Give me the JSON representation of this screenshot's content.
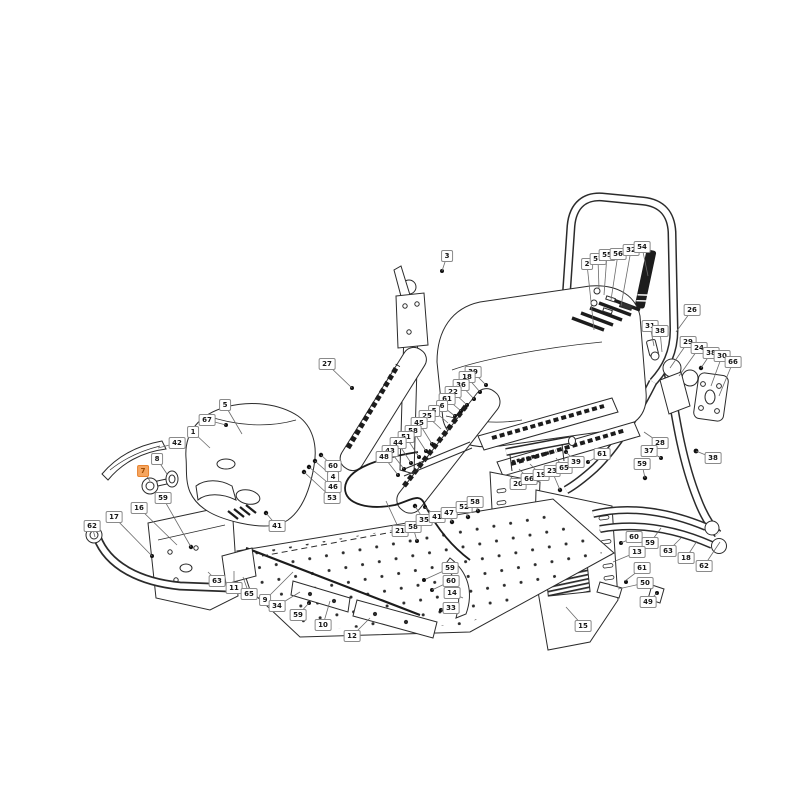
{
  "diagram": {
    "title": "mower-exploded-parts-diagram",
    "background": "#ffffff",
    "line_color": "#2b2b2b",
    "leader_color": "#6a6a6a",
    "label_style": {
      "bg": "#ffffff",
      "border": "#8a8a8a",
      "text": "#161616"
    },
    "highlight_style": {
      "bg": "#f5a55f",
      "border": "#e8832f",
      "text": "#9c4a00"
    },
    "highlighted_part": "7",
    "callouts": [
      {
        "n": "5",
        "x": 225,
        "y": 405,
        "tx": 242,
        "ty": 434
      },
      {
        "n": "67",
        "x": 207,
        "y": 420,
        "tx": 226,
        "ty": 425
      },
      {
        "n": "1",
        "x": 193,
        "y": 432,
        "tx": 210,
        "ty": 448
      },
      {
        "n": "42",
        "x": 177,
        "y": 443,
        "tx": 158,
        "ty": 448
      },
      {
        "n": "8",
        "x": 157,
        "y": 459,
        "tx": 167,
        "ty": 474
      },
      {
        "n": "7",
        "x": 143,
        "y": 471,
        "tx": 150,
        "ty": 481,
        "highlight": true
      },
      {
        "n": "59",
        "x": 163,
        "y": 498,
        "tx": 191,
        "ty": 547
      },
      {
        "n": "16",
        "x": 139,
        "y": 508,
        "tx": 177,
        "ty": 545
      },
      {
        "n": "17",
        "x": 114,
        "y": 517,
        "tx": 152,
        "ty": 556
      },
      {
        "n": "62",
        "x": 92,
        "y": 526,
        "tx": 95,
        "ty": 537
      },
      {
        "n": "41",
        "x": 277,
        "y": 526,
        "tx": 266,
        "ty": 513
      },
      {
        "n": "63",
        "x": 217,
        "y": 581,
        "tx": 208,
        "ty": 572
      },
      {
        "n": "11",
        "x": 234,
        "y": 588,
        "tx": 234,
        "ty": 571
      },
      {
        "n": "65",
        "x": 249,
        "y": 594,
        "tx": 243,
        "ty": 577
      },
      {
        "n": "9",
        "x": 265,
        "y": 600,
        "tx": 293,
        "ty": 572
      },
      {
        "n": "34",
        "x": 277,
        "y": 606,
        "tx": 300,
        "ty": 592
      },
      {
        "n": "59",
        "x": 298,
        "y": 615,
        "tx": 309,
        "ty": 603
      },
      {
        "n": "10",
        "x": 323,
        "y": 625,
        "tx": 330,
        "ty": 601
      },
      {
        "n": "12",
        "x": 352,
        "y": 636,
        "tx": 370,
        "ty": 618
      },
      {
        "n": "60",
        "x": 333,
        "y": 466,
        "tx": 321,
        "ty": 455
      },
      {
        "n": "4",
        "x": 333,
        "y": 477,
        "tx": 315,
        "ty": 461
      },
      {
        "n": "46",
        "x": 333,
        "y": 487,
        "tx": 309,
        "ty": 467
      },
      {
        "n": "53",
        "x": 332,
        "y": 498,
        "tx": 304,
        "ty": 472
      },
      {
        "n": "27",
        "x": 327,
        "y": 364,
        "tx": 352,
        "ty": 388
      },
      {
        "n": "3",
        "x": 447,
        "y": 256,
        "tx": 442,
        "ty": 271
      },
      {
        "n": "39",
        "x": 473,
        "y": 372,
        "tx": 486,
        "ty": 385
      },
      {
        "n": "18",
        "x": 467,
        "y": 377,
        "tx": 480,
        "ty": 392
      },
      {
        "n": "36",
        "x": 461,
        "y": 385,
        "tx": 474,
        "ty": 399
      },
      {
        "n": "22",
        "x": 453,
        "y": 392,
        "tx": 467,
        "ty": 405
      },
      {
        "n": "61",
        "x": 447,
        "y": 399,
        "tx": 461,
        "ty": 411
      },
      {
        "n": "6",
        "x": 442,
        "y": 406,
        "tx": 455,
        "ty": 416
      },
      {
        "n": "5",
        "x": 434,
        "y": 411,
        "tx": 448,
        "ty": 423
      },
      {
        "n": "25",
        "x": 427,
        "y": 416,
        "tx": 441,
        "ty": 429
      },
      {
        "n": "45",
        "x": 419,
        "y": 423,
        "tx": 432,
        "ty": 444
      },
      {
        "n": "58",
        "x": 413,
        "y": 431,
        "tx": 426,
        "ty": 451
      },
      {
        "n": "51",
        "x": 406,
        "y": 437,
        "tx": 419,
        "ty": 457
      },
      {
        "n": "44",
        "x": 398,
        "y": 443,
        "tx": 411,
        "ty": 463
      },
      {
        "n": "43",
        "x": 390,
        "y": 451,
        "tx": 404,
        "ty": 469
      },
      {
        "n": "48",
        "x": 384,
        "y": 457,
        "tx": 398,
        "ty": 475
      },
      {
        "n": "20",
        "x": 518,
        "y": 484,
        "tx": 508,
        "ty": 474
      },
      {
        "n": "66",
        "x": 529,
        "y": 479,
        "tx": 519,
        "ty": 469
      },
      {
        "n": "19",
        "x": 541,
        "y": 475,
        "tx": 530,
        "ty": 464
      },
      {
        "n": "23",
        "x": 552,
        "y": 471,
        "tx": 560,
        "ty": 490
      },
      {
        "n": "65",
        "x": 564,
        "y": 468,
        "tx": 556,
        "ty": 458
      },
      {
        "n": "39",
        "x": 576,
        "y": 462,
        "tx": 566,
        "ty": 452
      },
      {
        "n": "61",
        "x": 602,
        "y": 454,
        "tx": 588,
        "ty": 462
      },
      {
        "n": "2",
        "x": 587,
        "y": 264,
        "tx": 594,
        "ty": 330
      },
      {
        "n": "57",
        "x": 598,
        "y": 259,
        "tx": 599,
        "ty": 289
      },
      {
        "n": "55",
        "x": 607,
        "y": 255,
        "tx": 604,
        "ty": 295
      },
      {
        "n": "56",
        "x": 618,
        "y": 254,
        "tx": 611,
        "ty": 300
      },
      {
        "n": "32",
        "x": 631,
        "y": 250,
        "tx": 621,
        "ty": 306
      },
      {
        "n": "54",
        "x": 642,
        "y": 247,
        "tx": 648,
        "ty": 276
      },
      {
        "n": "26",
        "x": 692,
        "y": 310,
        "tx": 676,
        "ty": 332
      },
      {
        "n": "31",
        "x": 650,
        "y": 326,
        "tx": 654,
        "ty": 346
      },
      {
        "n": "38",
        "x": 660,
        "y": 331,
        "tx": 662,
        "ty": 352
      },
      {
        "n": "29",
        "x": 688,
        "y": 342,
        "tx": 670,
        "ty": 368
      },
      {
        "n": "24",
        "x": 699,
        "y": 348,
        "tx": 679,
        "ty": 376
      },
      {
        "n": "38",
        "x": 711,
        "y": 353,
        "tx": 701,
        "ty": 368
      },
      {
        "n": "30",
        "x": 722,
        "y": 356,
        "tx": 711,
        "ty": 386
      },
      {
        "n": "66",
        "x": 733,
        "y": 362,
        "tx": 719,
        "ty": 396
      },
      {
        "n": "28",
        "x": 660,
        "y": 443,
        "tx": 644,
        "ty": 432
      },
      {
        "n": "37",
        "x": 649,
        "y": 451,
        "tx": 661,
        "ty": 458
      },
      {
        "n": "59",
        "x": 642,
        "y": 464,
        "tx": 645,
        "ty": 478
      },
      {
        "n": "38",
        "x": 713,
        "y": 458,
        "tx": 696,
        "ty": 451
      },
      {
        "n": "60",
        "x": 634,
        "y": 537,
        "tx": 621,
        "ty": 543
      },
      {
        "n": "59",
        "x": 650,
        "y": 543,
        "tx": 661,
        "ty": 528
      },
      {
        "n": "63",
        "x": 668,
        "y": 551,
        "tx": 681,
        "ty": 538
      },
      {
        "n": "18",
        "x": 686,
        "y": 558,
        "tx": 697,
        "ty": 541
      },
      {
        "n": "62",
        "x": 704,
        "y": 566,
        "tx": 720,
        "ty": 542
      },
      {
        "n": "13",
        "x": 637,
        "y": 552,
        "tx": 613,
        "ty": 562
      },
      {
        "n": "61",
        "x": 642,
        "y": 568,
        "tx": 625,
        "ty": 581
      },
      {
        "n": "50",
        "x": 645,
        "y": 583,
        "tx": 618,
        "ty": 589
      },
      {
        "n": "49",
        "x": 648,
        "y": 602,
        "tx": 657,
        "ty": 593
      },
      {
        "n": "15",
        "x": 583,
        "y": 626,
        "tx": 566,
        "ty": 607
      },
      {
        "n": "59",
        "x": 450,
        "y": 568,
        "tx": 426,
        "ty": 579
      },
      {
        "n": "60",
        "x": 451,
        "y": 581,
        "tx": 432,
        "ty": 590
      },
      {
        "n": "14",
        "x": 452,
        "y": 593,
        "tx": 463,
        "ty": 598
      },
      {
        "n": "33",
        "x": 451,
        "y": 608,
        "tx": 441,
        "ty": 610
      },
      {
        "n": "21",
        "x": 400,
        "y": 531,
        "tx": 386,
        "ty": 501
      },
      {
        "n": "58",
        "x": 413,
        "y": 527,
        "tx": 417,
        "ty": 541
      },
      {
        "n": "35",
        "x": 424,
        "y": 520,
        "tx": 415,
        "ty": 506
      },
      {
        "n": "41",
        "x": 437,
        "y": 517,
        "tx": 425,
        "ty": 507
      },
      {
        "n": "47",
        "x": 449,
        "y": 513,
        "tx": 452,
        "ty": 522
      },
      {
        "n": "52",
        "x": 464,
        "y": 507,
        "tx": 468,
        "ty": 517
      },
      {
        "n": "58",
        "x": 475,
        "y": 502,
        "tx": 478,
        "ty": 511
      }
    ]
  }
}
